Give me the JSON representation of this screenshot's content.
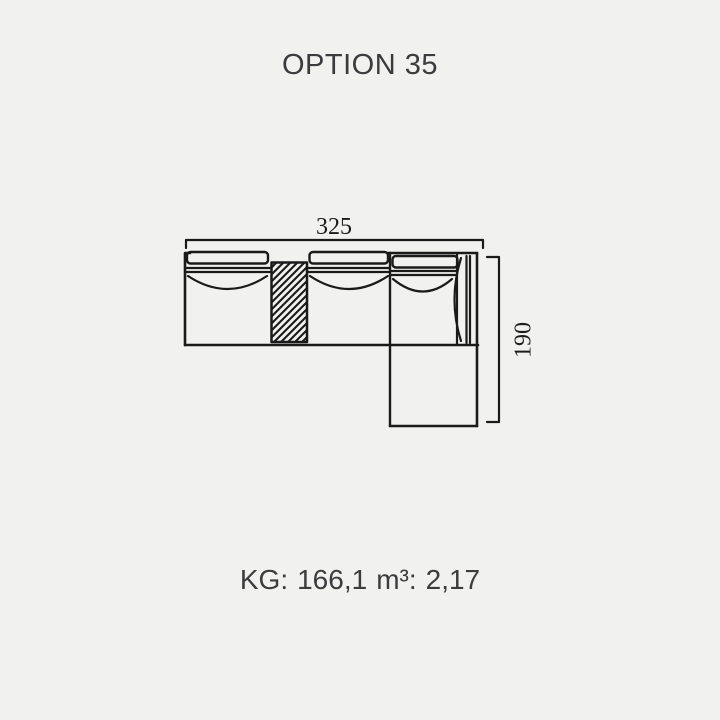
{
  "title": "OPTION 35",
  "diagram": {
    "width_label": "325",
    "depth_label": "190"
  },
  "specs": {
    "weight_label": "KG:",
    "weight_value": "166,1",
    "volume_label": "m³:",
    "volume_value": "2,17"
  },
  "colors": {
    "background": "#f1f2f0",
    "line": "#1a1a1a",
    "text": "#3b3b3d"
  }
}
